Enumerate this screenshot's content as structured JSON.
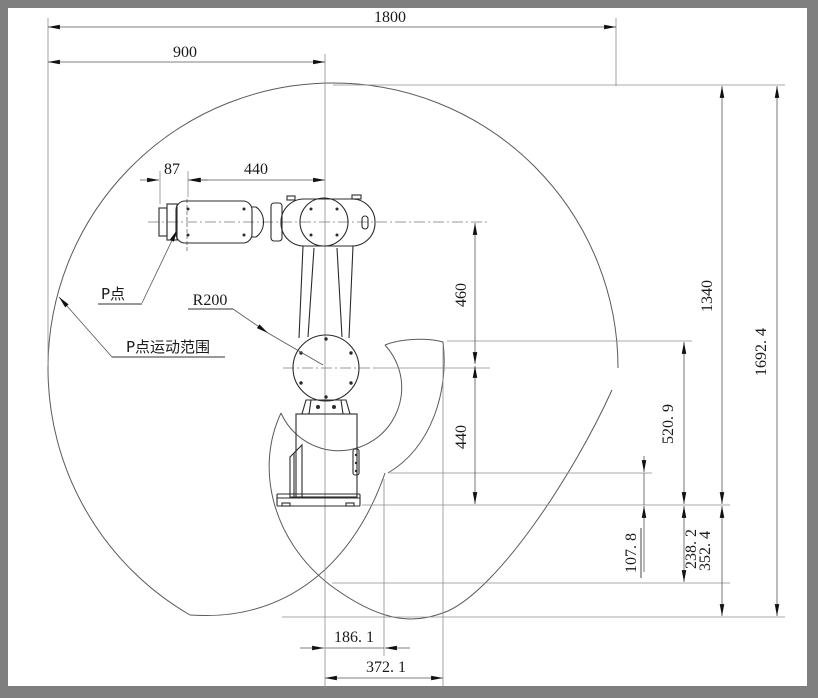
{
  "drawing": {
    "dims": {
      "total_width": "1800",
      "left_half": "900",
      "tool_flange": "87",
      "wrist_to_center": "440",
      "elbow_to_wrist": "460",
      "base_to_elbow": "440",
      "top_to_base": "1340",
      "overall_height": "1692. 4",
      "notch_height": "520. 9",
      "lower_small": "107. 8",
      "lower_mid": "238. 2",
      "lower_total": "352. 4",
      "cusp_near": "186. 1",
      "cusp_far": "372. 1"
    },
    "labels": {
      "p_point": "P点",
      "p_range": "P点运动范围",
      "radius": "R200"
    },
    "colors": {
      "frame": "#7f7f7f",
      "paper": "#ffffff",
      "line": "#2b2b2b"
    }
  }
}
